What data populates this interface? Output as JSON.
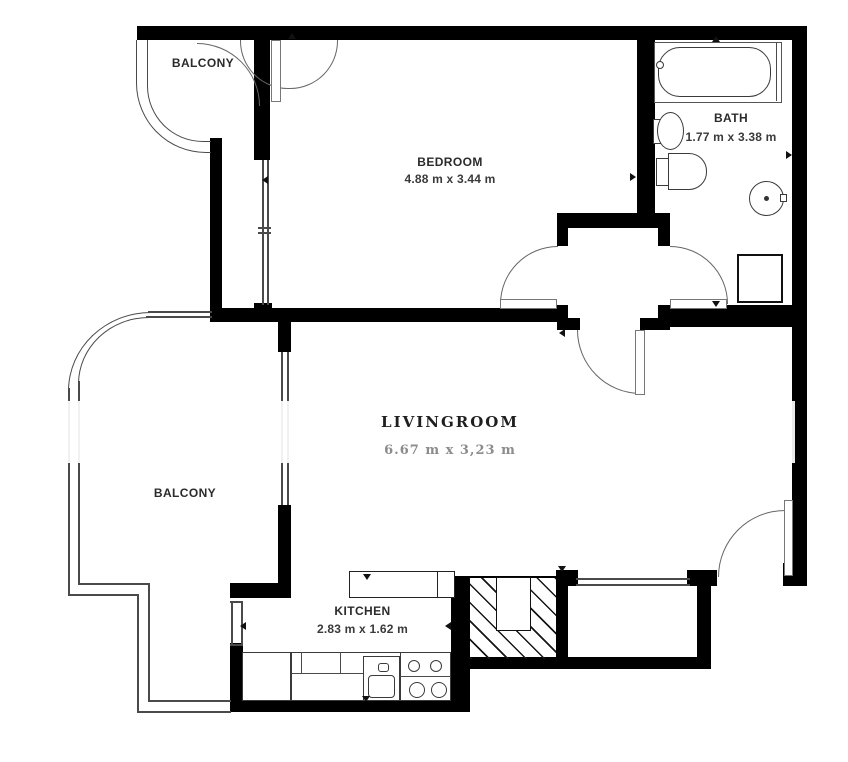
{
  "floorplan": {
    "rooms": [
      {
        "id": "balcony-top",
        "label": "BALCONY",
        "dimensions": null
      },
      {
        "id": "bedroom",
        "label": "BEDROOM",
        "dimensions": "4.88 m x 3.44 m"
      },
      {
        "id": "bath",
        "label": "BATH",
        "dimensions": "1.77 m x 3.38 m"
      },
      {
        "id": "livingroom",
        "label": "LIVINGROOM",
        "dimensions": "6.67 m x 3,23 m"
      },
      {
        "id": "balcony-left",
        "label": "BALCONY",
        "dimensions": null
      },
      {
        "id": "kitchen",
        "label": "KITCHEN",
        "dimensions": "2.83 m x 1.62 m"
      }
    ],
    "fixtures": [
      "bathtub",
      "bath-sink",
      "toilet",
      "washing-machine",
      "shower-tray",
      "kitchen-counter",
      "kitchen-sink",
      "stove-4-burners",
      "utility-shaft"
    ],
    "colors": {
      "wall": "#000000",
      "thin_line": "#4a4a4a",
      "label_text": "#2b2b2b",
      "livingroom_dim_text": "#8c8c8c",
      "background": "#ffffff"
    }
  }
}
